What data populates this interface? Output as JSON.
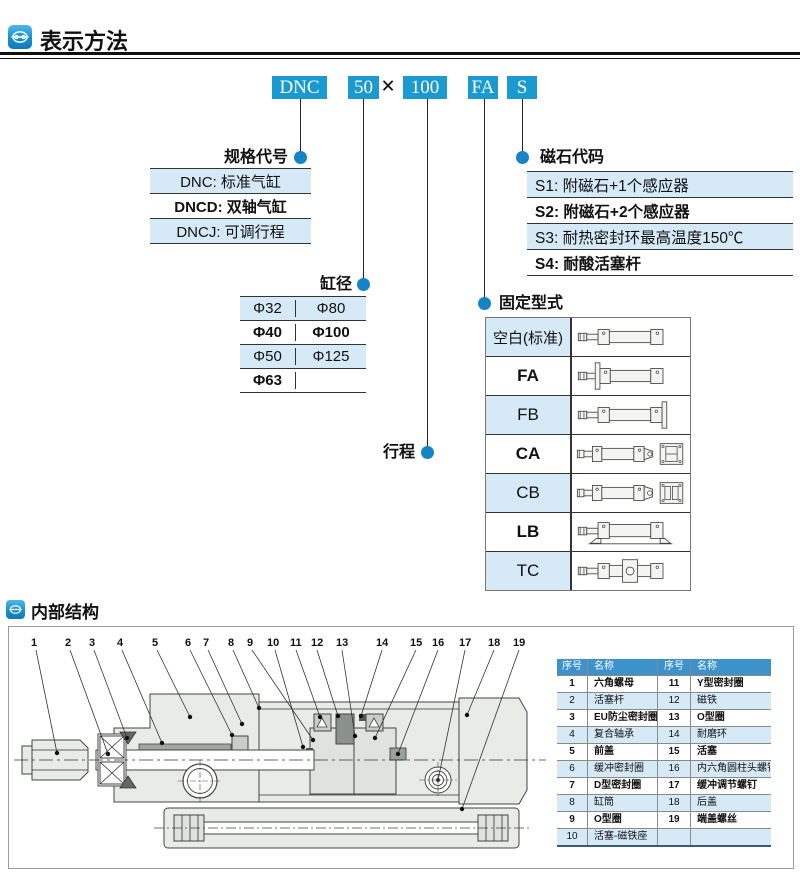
{
  "header": {
    "title": "表示方法"
  },
  "model_code": {
    "segments": [
      "DNC",
      "50",
      "100",
      "FA",
      "S"
    ],
    "separator": "×"
  },
  "spec_code": {
    "label": "规格代号",
    "rows": [
      "DNC: 标准气缸",
      "DNCD: 双轴气缸",
      "DNCJ: 可调行程"
    ]
  },
  "bore": {
    "label": "缸径",
    "rows": [
      [
        "Φ32",
        "Φ80"
      ],
      [
        "Φ40",
        "Φ100"
      ],
      [
        "Φ50",
        "Φ125"
      ],
      [
        "Φ63",
        ""
      ]
    ]
  },
  "stroke": {
    "label": "行程"
  },
  "magnet_code": {
    "label": "磁石代码",
    "rows": [
      "S1: 附磁石+1个感应器",
      "S2: 附磁石+2个感应器",
      "S3: 耐热密封环最高温度150℃",
      "S4: 耐酸活塞杆"
    ]
  },
  "mounting": {
    "label": "固定型式",
    "rows": [
      "空白(标准)",
      "FA",
      "FB",
      "CA",
      "CB",
      "LB",
      "TC"
    ]
  },
  "internal": {
    "title": "内部结构",
    "callouts": [
      "1",
      "2",
      "3",
      "4",
      "5",
      "6",
      "7",
      "8",
      "9",
      "10",
      "11",
      "12",
      "13",
      "14",
      "15",
      "16",
      "17",
      "18",
      "19"
    ],
    "table": {
      "headers": [
        "序号",
        "名称",
        "序号",
        "名称"
      ],
      "rows": [
        [
          "1",
          "六角螺母",
          "11",
          "Y型密封圈"
        ],
        [
          "2",
          "活塞杆",
          "12",
          "磁铁"
        ],
        [
          "3",
          "EU防尘密封圈",
          "13",
          "O型圈"
        ],
        [
          "4",
          "复合轴承",
          "14",
          "耐磨环"
        ],
        [
          "5",
          "前盖",
          "15",
          "活塞"
        ],
        [
          "6",
          "缓冲密封圈",
          "16",
          "内六角圆柱头螺钉"
        ],
        [
          "7",
          "D型密封圈",
          "17",
          "缓冲调节螺钉"
        ],
        [
          "8",
          "缸筒",
          "18",
          "后盖"
        ],
        [
          "9",
          "O型圈",
          "19",
          "端盖螺丝"
        ],
        [
          "10",
          "活塞-磁铁座",
          "",
          ""
        ]
      ]
    }
  },
  "colors": {
    "accent": "#1b9ad2",
    "light_row": "#d6e9f7",
    "table_header_blue": "#3e92cc",
    "dot_blue": "#1583c8"
  }
}
